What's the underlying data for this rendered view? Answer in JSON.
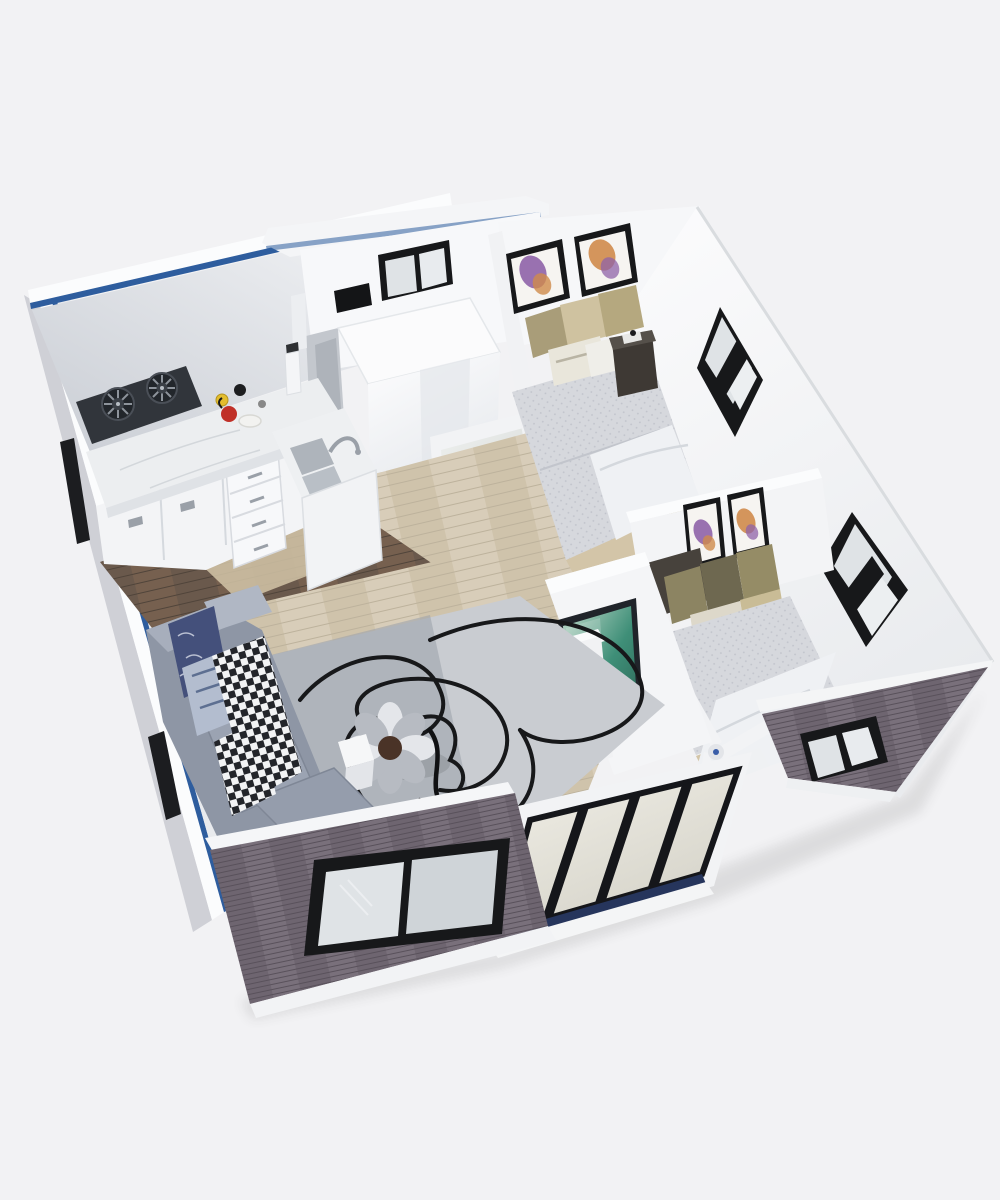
{
  "meta": {
    "description": "Isometric 3D cutaway rendering of a small two-bedroom expandable container house viewed from above, with open roof showing kitchen, bathroom, living room, TV partition, two bedrooms with butterfly artwork, and sliding glass entry doors, on a plain light gray background",
    "view": "isometric-top-down-cutaway",
    "style": "photorealistic-3d-render"
  },
  "palette": {
    "bg": "#f2f2f4",
    "wall-white": "#f6f7f9",
    "wall-rim": "#fbfcfd",
    "wall-shade": "#c9cdd4",
    "blue": "#2e5d9e",
    "ext-light": "#cfd0d6",
    "ext-wood": "#6e6570",
    "ext-wood-dark": "#59515b",
    "ext-wood-lite": "#79707b",
    "floor-dark": "#6a594c",
    "floor-dark-2": "#76604f",
    "floor-dark-line": "#50443a",
    "floor-light": "#d8cdb9",
    "floor-light-2": "#cfc3ab",
    "floor-light-line": "#bdb29c",
    "wood-tan": "#d3c5a8",
    "rug": "#b6b9bf",
    "rug-light": "#c9ccd1",
    "rug-dark": "#9fa3ab",
    "rug-line": "#17181a",
    "sofa": "#8e96a5",
    "sofa-light": "#a7aebc",
    "sofa-cushion": "#9ba3b2",
    "sofa-dark": "#79818f",
    "pillow-navy": "#44507b",
    "pillow-stripe": "#b3bdcf",
    "checker-dark": "#23252a",
    "checker-light": "#f2f3f4",
    "ottoman": "#b7bbc2",
    "ottoman-light": "#e4e6ea",
    "ottoman-center": "#4a3327",
    "marble": "#eceef0",
    "marble-edge": "#dfe2e6",
    "cabinet": "#f3f4f6",
    "cabinet-seam": "#d5d9de",
    "cooktop": "#31353b",
    "burner": "#22262b",
    "grate": "#8d939b",
    "sink": "#aeb4bb",
    "quilt": "#d6d8dd",
    "quilt-dot": "#b6b9c2",
    "blanket": "#eff1f4",
    "pillow-tan": "#cfc2a0",
    "pillow-tan-dark": "#a99d79",
    "pillow-olive": "#8c8462",
    "pillow-olive-dark": "#6e6850",
    "pillow-cream": "#ddd8ca",
    "headboard": "#47423c",
    "nightstand": "#3e3934",
    "frame-black": "#17181a",
    "art-mat": "#f6f4f1",
    "bfly-purple": "#8f63a8",
    "bfly-orange": "#d08b4b",
    "window-frame": "#17181a",
    "window-glass": "#dfe3e6",
    "window-glass-2": "#cfd4d8",
    "tv-teal-1": "#3f8f78",
    "tv-teal-2": "#c2dccc",
    "console": "#f1f2f4",
    "slot": "#17181b",
    "door-glass-1": "#f1efe7",
    "door-glass-2": "#d5d3c9",
    "door-rail": "#26355c",
    "shower-1": "#fdfdfe",
    "shower-2": "#dde1e6",
    "kettle-red": "#c03028",
    "cup-yellow": "#e3bd2e",
    "shadow": "#1a1a1a"
  },
  "scene": {
    "rooms": [
      {
        "name": "kitchen",
        "position": "top-left",
        "furniture": [
          "two-burner-gas-cooktop",
          "marble-l-counter",
          "white-base-cabinets",
          "drawer-unit",
          "double-sink-with-faucet",
          "cups-and-plates",
          "blender",
          "dark-wood-floor"
        ]
      },
      {
        "name": "bathroom",
        "position": "top-center",
        "furniture": [
          "white-shower-enclosure",
          "glass-door",
          "black-framed-window",
          "wall-vent"
        ]
      },
      {
        "name": "bedroom-1",
        "position": "top-right",
        "furniture": [
          "double-bed-gray-quilt",
          "tan-pillows",
          "dark-nightstand",
          "two-butterfly-art-frames",
          "diamond-window"
        ]
      },
      {
        "name": "bedroom-2",
        "position": "mid-right",
        "furniture": [
          "double-bed-gray-quilt",
          "olive-pillows",
          "dark-headboard-bench",
          "white-ceiling-fan",
          "two-butterfly-art-frames",
          "diamond-window",
          "front-window"
        ]
      },
      {
        "name": "living-room",
        "position": "bottom-left",
        "furniture": [
          "gray-l-shaped-sofa",
          "navy-pattern-pillow",
          "striped-pillows",
          "checkered-throw",
          "gray-area-rug-with-line-art",
          "flower-shaped-ottoman",
          "white-side-table",
          "black-cable",
          "front-window"
        ]
      },
      {
        "name": "entry",
        "position": "bottom-center",
        "furniture": [
          "black-framed-sliding-glass-doors",
          "white-step",
          "white-porch-railing"
        ]
      },
      {
        "name": "hallway",
        "position": "center",
        "furniture": [
          "tv-partition-wall",
          "wall-mounted-tv-teal-art",
          "white-media-console",
          "light-wood-floor"
        ]
      }
    ],
    "exterior": {
      "cladding": "dark-woodgrain-panels",
      "trim": "white",
      "accent_stripe": "blue",
      "window_count": 6
    },
    "background": "plain-light-gray"
  }
}
